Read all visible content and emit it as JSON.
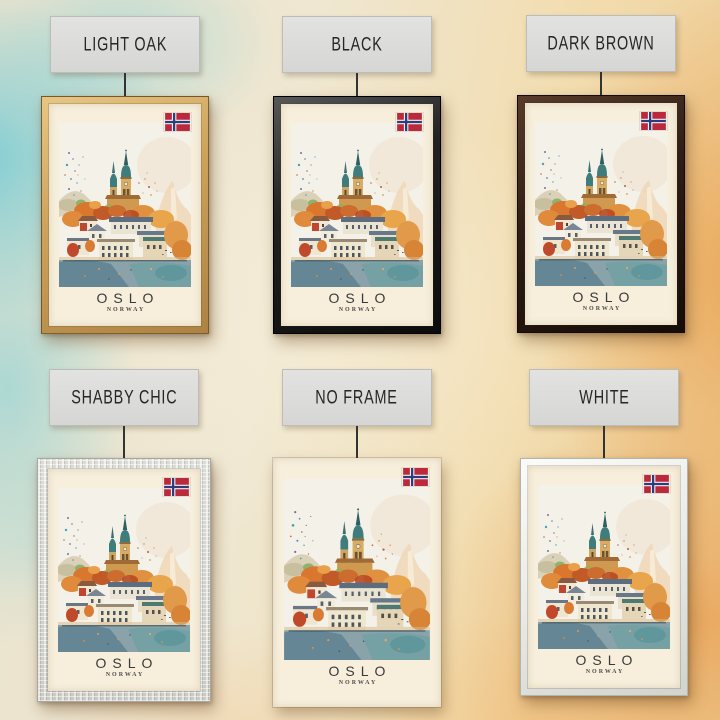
{
  "scene": {
    "description": "Six framed versions of an Oslo Norway watercolor travel poster hung on a teal-and-orange watercolor wall",
    "wall_colors": {
      "teal": "#5ec7d6",
      "cream": "#efe7d1",
      "orange": "#eda054"
    }
  },
  "variants": [
    {
      "label": "LIGHT OAK",
      "frame_color": "#cda35c"
    },
    {
      "label": "BLACK",
      "frame_color": "#1c1c1c"
    },
    {
      "label": "DARK BROWN",
      "frame_color": "#2e1d13"
    },
    {
      "label": "SHABBY CHIC",
      "frame_color": "#d7d7d1"
    },
    {
      "label": "NO FRAME",
      "frame_color": "none"
    },
    {
      "label": "WHITE",
      "frame_color": "#e9e9e5"
    }
  ],
  "poster": {
    "title": "OSLO",
    "subtitle": "NORWAY",
    "paper_color": "#f7efdc",
    "flag_icon": "norway-flag-icon",
    "art_description": "Autumn watercolor of Oslo: church with two green spires, orange foliage, white buildings, harbor water, paint splatter"
  }
}
